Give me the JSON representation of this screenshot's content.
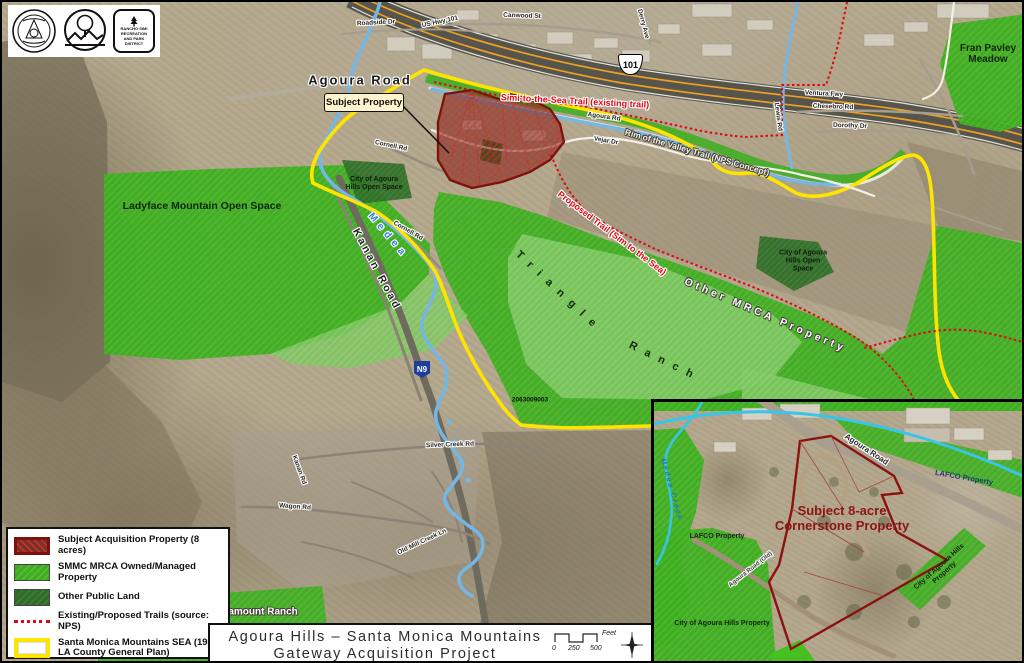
{
  "logos": {
    "seal": "los-angeles-county-seal",
    "smmc": "santa-monica-mountains-conservancy-logo",
    "rancho_simi_lines": [
      "RANCHO SIMI",
      "RECREATION",
      "AND PARK",
      "DISTRICT"
    ]
  },
  "map": {
    "agoura_road_label": "Agoura Road",
    "callout": "Subject Property",
    "shield_101": "101",
    "shield_n9": "N9",
    "areas": {
      "ladyface": "Ladyface Mountain Open Space",
      "fran_pavley": "Fran Pavley Meadow",
      "city_open_space": "City of Agoura Hills Open Space",
      "triangle": "Triangle",
      "ranch": "Ranch",
      "other_mrca": "Other MRCA Property",
      "kanan_road": "Kanan Road",
      "medea": "Medea",
      "paramount": "Paramount Ranch",
      "parcel_number": "2063009003"
    },
    "trails": {
      "simi_to_sea": "Simi-to-the-Sea Trail (existing trail)",
      "rim_valley": "Rim of the Valley Trail (NPS Concept)",
      "proposed": "Proposed Trail (Sim to the Sea)"
    },
    "streets": [
      "Roadside Dr",
      "US Hwy 101",
      "Canwood St",
      "Derry Ave",
      "Ventura Fwy",
      "Chesebro Rd",
      "Dorothy Dr",
      "Agoura Rd",
      "Vejar Dr",
      "Lewis Rd",
      "Cornell Rd",
      "Silver Creek Rd",
      "Wagon Rd",
      "Old Mill Creek Ln",
      "Kanan Rd"
    ]
  },
  "legend": {
    "items": [
      {
        "label": "Subject Acquisition Property (8 acres)"
      },
      {
        "label": "SMMC MRCA Owned/Managed Property"
      },
      {
        "label": "Other Public Land"
      },
      {
        "label": "Existing/Proposed Trails (source: NPS)"
      },
      {
        "label": "Santa Monica Mountains SEA (1980 LA County General Plan)"
      }
    ]
  },
  "title_block": {
    "line1": "Agoura Hills – Santa Monica Mountains",
    "line2": "Gateway Acquisition Project",
    "scale_ticks": [
      "0",
      "250",
      "500"
    ],
    "scale_unit": "Feet"
  },
  "inset": {
    "agoura_road": "Agoura Road",
    "lafco_right": "LAFCO Property",
    "lafco_left": "LAFCO Property",
    "medea_creek": "Medea Creek",
    "subject_line1": "Subject 8-acre",
    "subject_line2": "Cornerstone Property",
    "city_property_left": "City of Agoura Hills Property",
    "city_property_right": "City of Agoura Hills Property",
    "old_road": "Agoura Road (Old)"
  },
  "colors": {
    "smmc_green": "#3fae21",
    "other_public_green": "#2f6e28",
    "sea_yellow": "#ffe400",
    "trail_red": "#e30613",
    "subject_dark_red": "#7d120c",
    "creek_blue": "#74b7e6",
    "freeway_orange": "#f0a020"
  }
}
